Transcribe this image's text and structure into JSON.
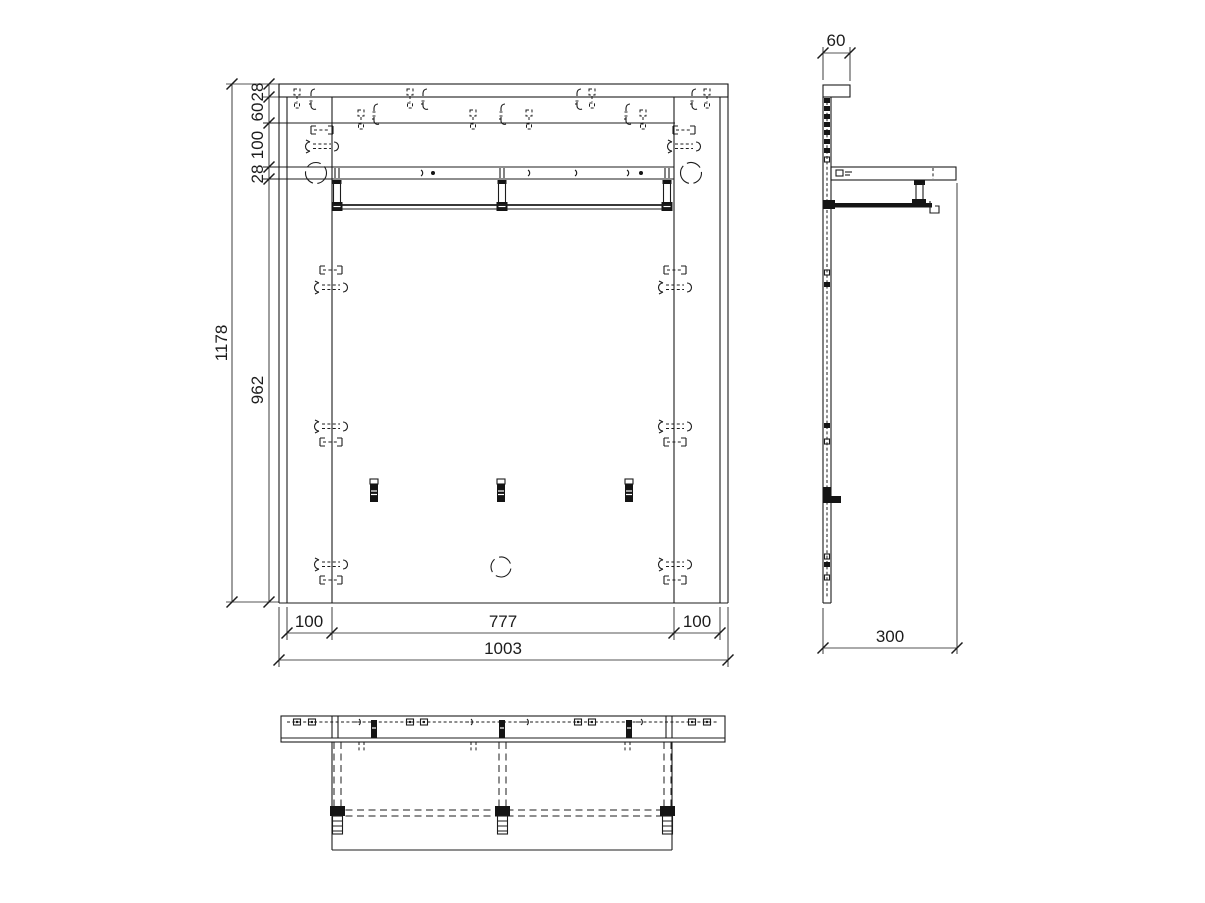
{
  "drawing": {
    "type": "furniture-technical-drawing",
    "views": [
      "front",
      "side",
      "bottom"
    ],
    "colors": {
      "line": "#1c1c1c",
      "background": "#ffffff"
    }
  },
  "front_view": {
    "total_height": "1178",
    "lower_height": "962",
    "left_chain_top": "28",
    "left_chain_second": "60",
    "left_chain_third": "100",
    "left_chain_fourth": "28",
    "bottom_left": "100",
    "bottom_center": "777",
    "bottom_right": "100",
    "total_width": "1003"
  },
  "side_view": {
    "top_width": "60",
    "depth": "300"
  }
}
